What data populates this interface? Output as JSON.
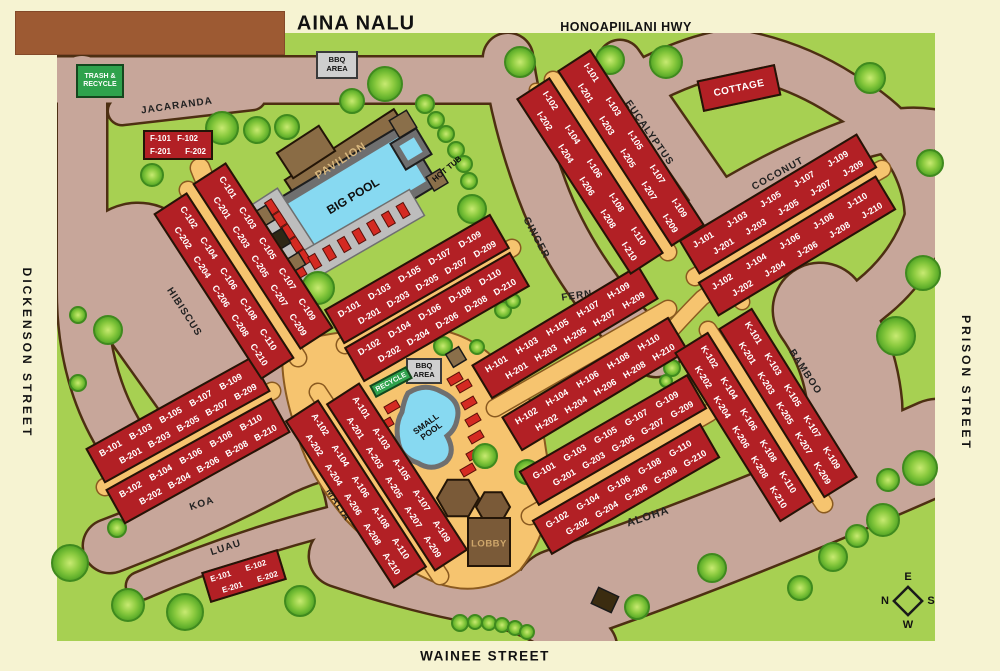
{
  "header": {
    "title": "AINA NALU",
    "highway": "HONOAPIILANI HWY"
  },
  "streets": {
    "left": "DICKENSON STREET",
    "right": "PRISON STREET",
    "bottom": "WAINEE STREET"
  },
  "road_labels": {
    "jacaranda": "JACARANDA",
    "hibiscus": "HIBISCUS",
    "ginger": "GINGER",
    "fern": "FERN",
    "eucalyptus": "EUCALYPTUS",
    "coconut": "COCONUT",
    "koa": "KOA",
    "luau": "LUAU",
    "malia": "MALIA",
    "aloha": "ALOHA",
    "bamboo": "BAMBOO"
  },
  "facilities": {
    "pavilion": "PAVILION",
    "big_pool": "BIG POOL",
    "hot_tub": "HOT TUB",
    "small_pool": "SMALL POOL",
    "lobby": "LOBBY",
    "cottage": "COTTAGE"
  },
  "signs": {
    "trash_recycle": "TRASH & RECYCLE",
    "bbq_top": "BBQ AREA",
    "bbq_mid": "BBQ AREA",
    "recycle_mid": "RECYCLE"
  },
  "compass": {
    "north": "N",
    "east": "E",
    "south": "S",
    "west": "W"
  },
  "buildings": [
    {
      "id": "F",
      "units_row1": [
        "F-101",
        "F-102"
      ],
      "units_row2": [
        "F-201",
        "F-202"
      ]
    },
    {
      "id": "E",
      "units_row1": [
        "E-101",
        "E-102"
      ],
      "units_row2": [
        "E-201",
        "E-202"
      ]
    },
    {
      "id": "A-odd",
      "units_row1": [
        "A-101",
        "A-103",
        "A-105",
        "A-107",
        "A-109"
      ],
      "units_row2": [
        "A-201",
        "A-203",
        "A-205",
        "A-207",
        "A-209"
      ]
    },
    {
      "id": "A-even",
      "units_row1": [
        "A-102",
        "A-104",
        "A-106",
        "A-108",
        "A-110"
      ],
      "units_row2": [
        "A-202",
        "A-204",
        "A-206",
        "A-208",
        "A-210"
      ]
    },
    {
      "id": "B-odd",
      "units_row1": [
        "B-101",
        "B-103",
        "B-105",
        "B-107",
        "B-109"
      ],
      "units_row2": [
        "B-201",
        "B-203",
        "B-205",
        "B-207",
        "B-209"
      ]
    },
    {
      "id": "B-even",
      "units_row1": [
        "B-102",
        "B-104",
        "B-106",
        "B-108",
        "B-110"
      ],
      "units_row2": [
        "B-202",
        "B-204",
        "B-206",
        "B-208",
        "B-210"
      ]
    },
    {
      "id": "C-odd",
      "units_row1": [
        "C-101",
        "C-103",
        "C-105",
        "C-107",
        "C-109"
      ],
      "units_row2": [
        "C-201",
        "C-203",
        "C-205",
        "C-207",
        "C-209"
      ]
    },
    {
      "id": "C-even",
      "units_row1": [
        "C-102",
        "C-104",
        "C-106",
        "C-108",
        "C-110"
      ],
      "units_row2": [
        "C-202",
        "C-204",
        "C-206",
        "C-208",
        "C-210"
      ]
    },
    {
      "id": "D-odd",
      "units_row1": [
        "D-101",
        "D-103",
        "D-105",
        "D-107",
        "D-109"
      ],
      "units_row2": [
        "D-201",
        "D-203",
        "D-205",
        "D-207",
        "D-209"
      ]
    },
    {
      "id": "D-even",
      "units_row1": [
        "D-102",
        "D-104",
        "D-106",
        "D-108",
        "D-110"
      ],
      "units_row2": [
        "D-202",
        "D-204",
        "D-206",
        "D-208",
        "D-210"
      ]
    },
    {
      "id": "G-odd",
      "units_row1": [
        "G-101",
        "G-103",
        "G-105",
        "G-107",
        "G-109"
      ],
      "units_row2": [
        "G-201",
        "G-203",
        "G-205",
        "G-207",
        "G-209"
      ]
    },
    {
      "id": "G-even",
      "units_row1": [
        "G-102",
        "G-104",
        "G-106",
        "G-108",
        "G-110"
      ],
      "units_row2": [
        "G-202",
        "G-204",
        "G-206",
        "G-208",
        "G-210"
      ]
    },
    {
      "id": "H-odd",
      "units_row1": [
        "H-101",
        "H-103",
        "H-105",
        "H-107",
        "H-109"
      ],
      "units_row2": [
        "H-201",
        "H-203",
        "H-205",
        "H-207",
        "H-209"
      ]
    },
    {
      "id": "H-even",
      "units_row1": [
        "H-102",
        "H-104",
        "H-106",
        "H-108",
        "H-110"
      ],
      "units_row2": [
        "H-202",
        "H-204",
        "H-206",
        "H-208",
        "H-210"
      ]
    },
    {
      "id": "I-odd",
      "units_row1": [
        "I-101",
        "I-103",
        "I-105",
        "I-107",
        "I-109"
      ],
      "units_row2": [
        "I-201",
        "I-203",
        "I-205",
        "I-207",
        "I-209"
      ]
    },
    {
      "id": "I-even",
      "units_row1": [
        "I-102",
        "I-104",
        "I-106",
        "I-108",
        "I-110"
      ],
      "units_row2": [
        "I-202",
        "I-204",
        "I-206",
        "I-208",
        "I-210"
      ]
    },
    {
      "id": "J-odd",
      "units_row1": [
        "J-101",
        "J-103",
        "J-105",
        "J-107",
        "J-109"
      ],
      "units_row2": [
        "J-201",
        "J-203",
        "J-205",
        "J-207",
        "J-209"
      ]
    },
    {
      "id": "J-even",
      "units_row1": [
        "J-102",
        "J-104",
        "J-106",
        "J-108",
        "J-110"
      ],
      "units_row2": [
        "J-202",
        "J-204",
        "J-206",
        "J-208",
        "J-210"
      ]
    },
    {
      "id": "K-odd",
      "units_row1": [
        "K-101",
        "K-103",
        "K-105",
        "K-107",
        "K-109"
      ],
      "units_row2": [
        "K-201",
        "K-203",
        "K-205",
        "K-207",
        "K-209"
      ]
    },
    {
      "id": "K-even",
      "units_row1": [
        "K-102",
        "K-104",
        "K-106",
        "K-108",
        "K-110"
      ],
      "units_row2": [
        "K-202",
        "K-204",
        "K-206",
        "K-208",
        "K-210"
      ]
    }
  ],
  "colors": {
    "grass": "#a7d052",
    "road": "#c7a69a",
    "path": "#f6c46f",
    "building": "#b22025",
    "pool": "#87d9f1",
    "wood": "#8a6c45",
    "cream": "#f6f3d2",
    "sign_green": "#2fa24c"
  }
}
